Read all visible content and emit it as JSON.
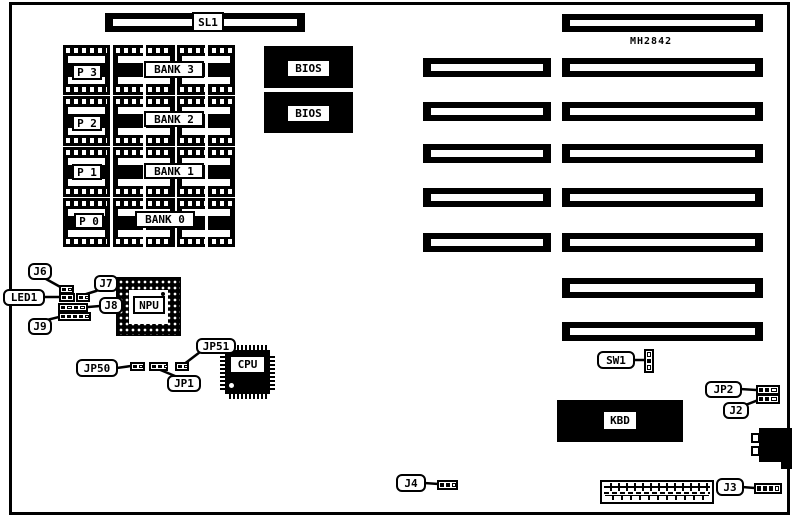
{
  "diagram": {
    "title_note": "",
    "colors": {
      "ink": "#000000",
      "paper": "#ffffff"
    },
    "slot_sl1_label": "SL1",
    "chip_id_label": "MH2842",
    "memory": {
      "rows": [
        {
          "p": "P 3",
          "bank": "BANK 3"
        },
        {
          "p": "P 2",
          "bank": "BANK 2"
        },
        {
          "p": "P 1",
          "bank": "BANK 1"
        },
        {
          "p": "P 0",
          "bank": "BANK 0"
        }
      ]
    },
    "bios1_label": "BIOS",
    "bios2_label": "BIOS",
    "npu_label": "NPU",
    "cpu_label": "CPU",
    "kbd_label": "KBD",
    "callouts": {
      "j6": "J6",
      "led1": "LED1",
      "j7": "J7",
      "j8": "J8",
      "j9": "J9",
      "jp50": "JP50",
      "jp1": "JP1",
      "jp51": "JP51",
      "sw1": "SW1",
      "jp2": "JP2",
      "j2": "J2",
      "j4": "J4",
      "j3": "J3"
    }
  }
}
